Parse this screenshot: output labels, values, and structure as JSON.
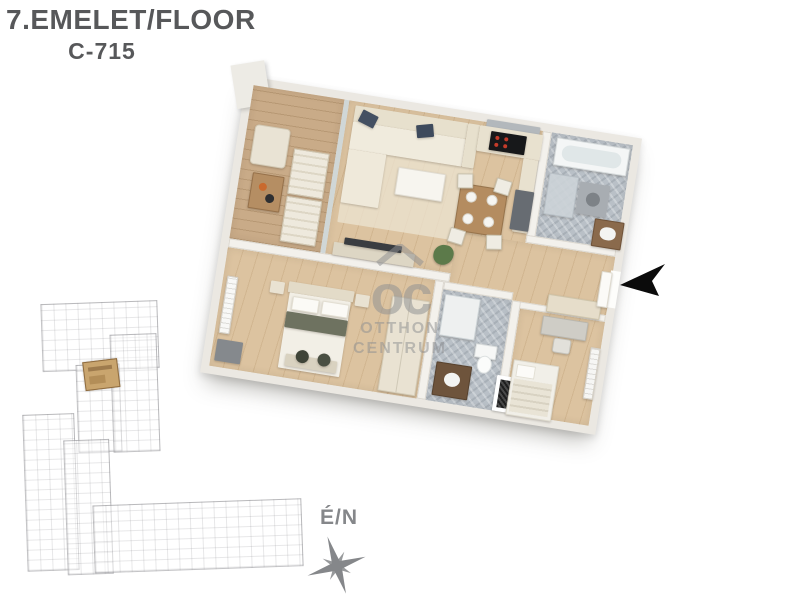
{
  "header": {
    "title": "7.EMELET/FLOOR",
    "unit_code": "C-715"
  },
  "floorplan": {
    "rooms": [
      "balcony",
      "living-room-kitchen",
      "bathroom",
      "hallway",
      "bedroom",
      "shower-room",
      "bedroom-2",
      "utility-shaft"
    ],
    "entrance_marker": "black-arrow-pointing-left"
  },
  "site_plan": {
    "highlight": "unit-location"
  },
  "compass": {
    "label": "É/N"
  },
  "watermark": {
    "monogram": "oc",
    "name_line1": "OTTHON",
    "name_line2": "CENTRUM"
  },
  "colors": {
    "title_text": "#57585a",
    "wall": "#f3f1ec",
    "wood_floor": "#dcc3a0",
    "balcony_deck": "#c9ab88",
    "tile_floor": "#b9c0c7",
    "sofa_cream": "#f0ebdd",
    "pillow_navy": "#445062",
    "site_highlight": "#c9a56e",
    "watermark_gray": "#8f9092",
    "compass_gray": "#85878a",
    "arrow_black": "#0b0b0b"
  }
}
